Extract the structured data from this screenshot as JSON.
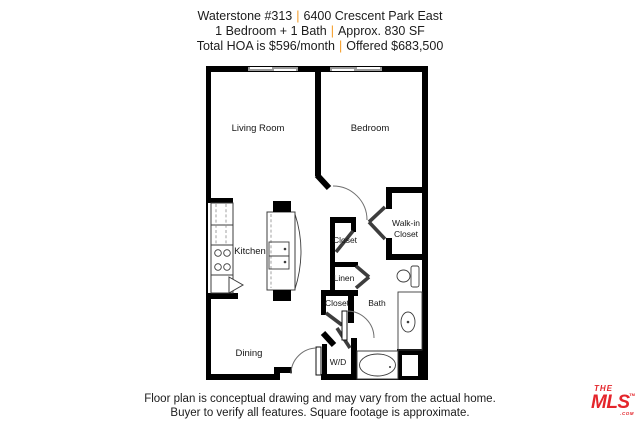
{
  "header": {
    "line1": {
      "left": "Waterstone #313",
      "divider": "|",
      "right": "6400 Crescent Park East"
    },
    "line2": {
      "left": "1 Bedroom + 1 Bath",
      "divider": "|",
      "right": "Approx. 830 SF"
    },
    "line3": {
      "left": "Total HOA is $596/month",
      "divider": "|",
      "right": "Offered $683,500"
    }
  },
  "floorplan": {
    "rooms": {
      "living_room": "Living Room",
      "bedroom": "Bedroom",
      "kitchen": "Kitchen",
      "dining": "Dining",
      "walk_in_line1": "Walk-in",
      "walk_in_line2": "Closet",
      "closet_hall": "Closet",
      "linen": "Linen",
      "closet_lower": "Closet",
      "bath": "Bath",
      "washer_dryer": "W/D"
    }
  },
  "footer": {
    "line1": "Floor plan is conceptual drawing and may vary from the actual home.",
    "line2": "Buyer to verify all features. Square footage is approximate."
  },
  "logo": {
    "the": "THE",
    "mls": "MLS",
    "trademark": "TM",
    "com": ".COM"
  },
  "colors": {
    "divider_orange": "#F59B23",
    "logo_red": "#E4252B",
    "wall_black": "#000000"
  }
}
